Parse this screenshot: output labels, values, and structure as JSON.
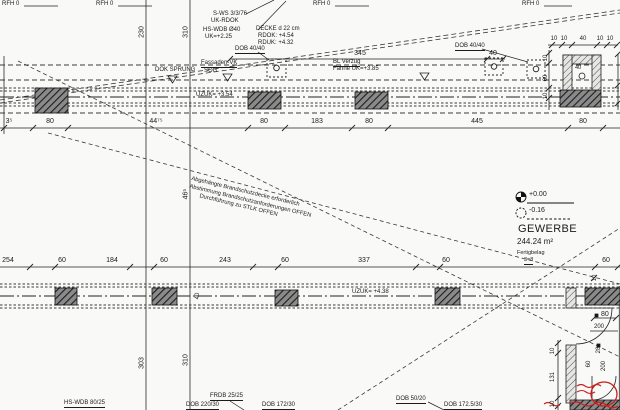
{
  "colors": {
    "paper": "#f9f9f7",
    "ink": "#1b1b1b",
    "line": "#2b2b2b",
    "red": "#c9201d",
    "pier_fill": "#8a8a8a"
  },
  "top_marks": {
    "rfh": "RFH 0"
  },
  "notes": {
    "sws": "S-WS 3/3/76",
    "ukrdok": "UK-RDOK",
    "hswdb": "HS-WDB Ø40",
    "uk": "UK=+2.25",
    "decke": "DECKE d 22 cm",
    "rdok": "RDOK: +4.54",
    "rduk": "RDUK: +4.32",
    "dob": "DOB 40/40"
  },
  "band": {
    "dok_sprung": "DOK SPRUNG",
    "fassade": "Fassaden-VK",
    "sog": "SOG",
    "verzug": "BL Verzug",
    "fahne": "Fahne UK=+3.85",
    "uzuk_top": "UZUK= +3.54",
    "uzuk_bottom": "UZUK= +4.38"
  },
  "diag_note": {
    "l1": "Abgehängte Brandschutzdecke erforderlich",
    "l2": "Abstimmung Brandschutzanforderungen OFFEN",
    "l3": "Durchführung zu STLK OFFEN"
  },
  "levels": {
    "zero": "+0.00",
    "minus": "-0.16"
  },
  "room": {
    "name": "GEWERBE",
    "area": "244.24 m²",
    "finish": "Fertigbelag",
    "code": "3=8"
  },
  "dims": {
    "span345": "345",
    "span40": "40",
    "chain": [
      "10",
      "10",
      "40",
      "10",
      "10"
    ],
    "u_left": [
      "10",
      "60",
      "10"
    ],
    "u_inner": "40",
    "row_top": [
      "3⁵",
      "80",
      "44⁷⁵",
      "80",
      "183",
      "80",
      "445",
      "80"
    ],
    "row_bottom": [
      "254",
      "60",
      "184",
      "60",
      "243",
      "60",
      "337",
      "60",
      "60"
    ],
    "v146_top": "230",
    "v190_top": "310",
    "v190_mid": "46⁵",
    "v146_bottom": "303",
    "v190_bottom": "310",
    "cross40": "40"
  },
  "door": {
    "w80": "80",
    "h200": "200",
    "v200": "200",
    "v60": "60",
    "v28": "28",
    "v131": "131",
    "t10a": "10",
    "t10b": "10",
    "t10c": "10"
  },
  "footer": {
    "labels": [
      "HS-WDB 80/25",
      "FRDB 25/25",
      "DOB 220/30",
      "DOB 172/30",
      "DOB 50/20",
      "DOB 172.5/30"
    ]
  }
}
